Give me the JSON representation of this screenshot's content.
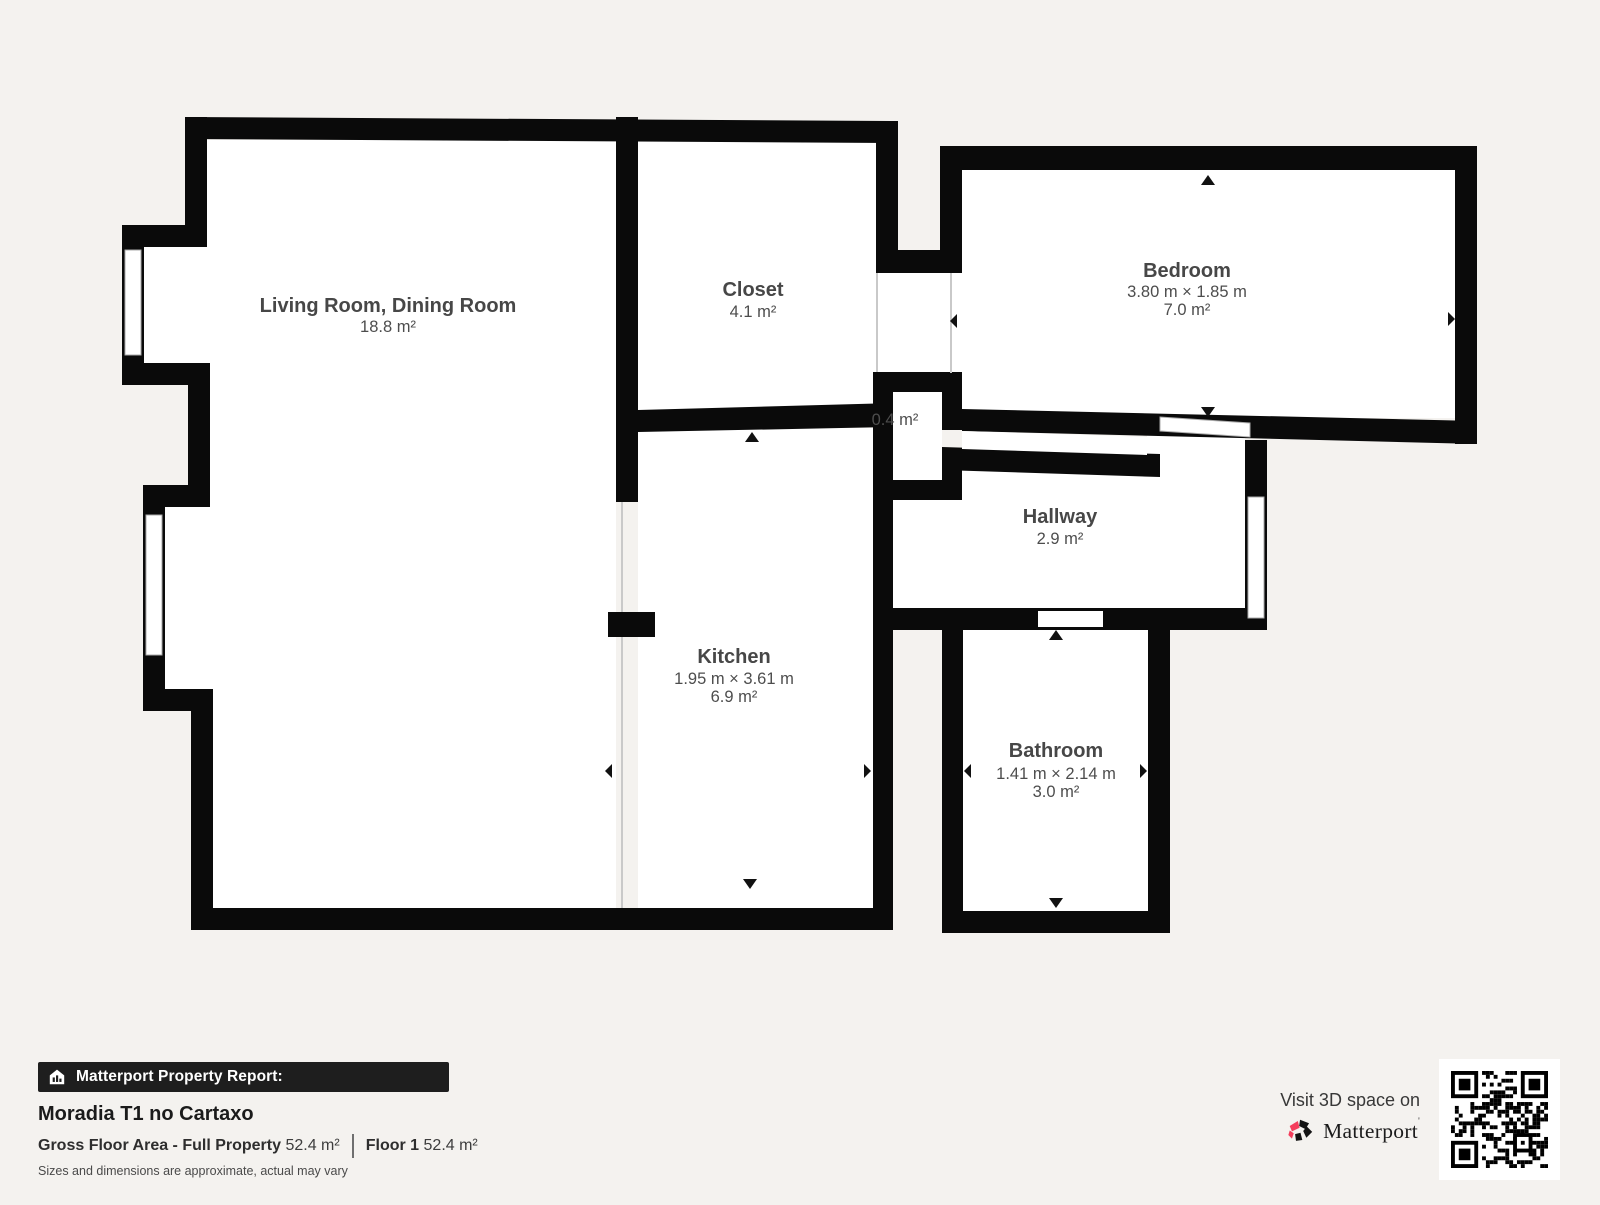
{
  "plan": {
    "rooms": {
      "living": {
        "name": "Living Room, Dining Room",
        "area": "18.8 m²"
      },
      "closet": {
        "name": "Closet",
        "area": "4.1 m²"
      },
      "bedroom": {
        "name": "Bedroom",
        "dims": "3.80 m × 1.85 m",
        "area": "7.0 m²"
      },
      "nook": {
        "area": "0.4 m²"
      },
      "hallway": {
        "name": "Hallway",
        "area": "2.9 m²"
      },
      "kitchen": {
        "name": "Kitchen",
        "dims": "1.95 m × 3.61 m",
        "area": "6.9 m²"
      },
      "bathroom": {
        "name": "Bathroom",
        "dims": "1.41 m × 2.14 m",
        "area": "3.0 m²"
      }
    },
    "colors": {
      "wall": "#0a0a0a",
      "room": "#ffffff",
      "background": "#f4f2ef",
      "label": "#474747",
      "brand_red": "#f43e5c"
    }
  },
  "report": {
    "header": "Matterport Property Report:",
    "property_name": "Moradia T1 no Cartaxo",
    "gross_label": "Gross Floor Area - Full Property",
    "gross_value": "52.4 m²",
    "floor_label": "Floor 1",
    "floor_value": "52.4 m²",
    "disclaimer": "Sizes and dimensions are approximate, actual may vary"
  },
  "promo": {
    "visit_text": "Visit 3D space on",
    "brand": "Matterport"
  }
}
